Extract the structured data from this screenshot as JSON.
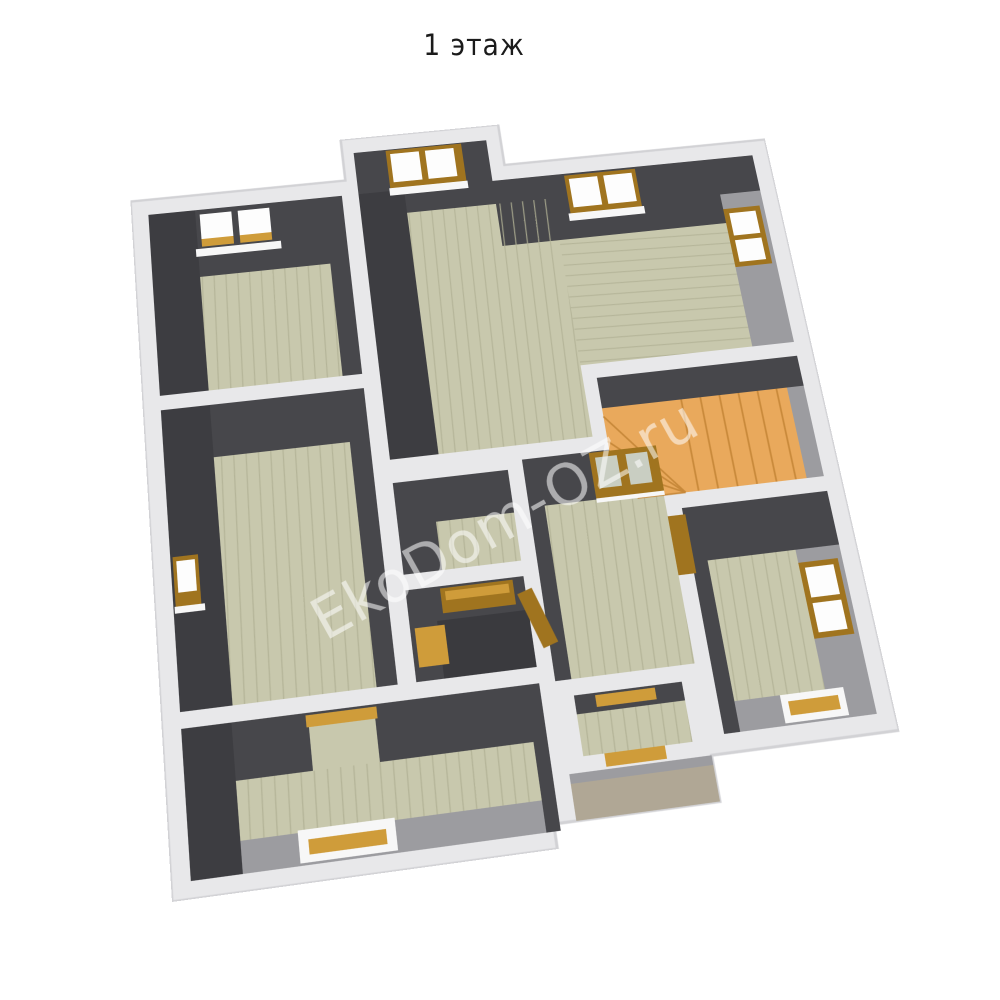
{
  "title": "1 этаж",
  "watermark": "EkoDom-OZ.ru",
  "scene": {
    "type": "3d-floor-plan-render",
    "floor_shown": "first floor",
    "rooms_visible": 9,
    "features": [
      "roof-windows",
      "wall-windows",
      "double-glass-door",
      "winder-staircase",
      "bathroom-fixtures",
      "entrance-porch"
    ]
  },
  "colors": {
    "background": "#ffffff",
    "wall_top_band": "#e8e8ea",
    "band_edge": "#d2d2d5",
    "wall_dark": "#47474b",
    "wall_dark_deep": "#3d3d41",
    "wall_light": "#9c9ca0",
    "floor": "#c8c8ad",
    "floor_stripe": "#b2b295",
    "floor_dark": "#3a3a3e",
    "stairs": "#e9a95c",
    "stairs_edge": "#c8893a",
    "wood": "#a0741f",
    "wood_light": "#cf9c3a",
    "sill_white": "#f7f7f7",
    "glass": "#fdfdfd",
    "door_glass": "#c9cec2",
    "porch_floor": "#b0a795",
    "title_color": "#1b1b1b",
    "watermark_color": "rgba(255,255,255,0.55)"
  }
}
